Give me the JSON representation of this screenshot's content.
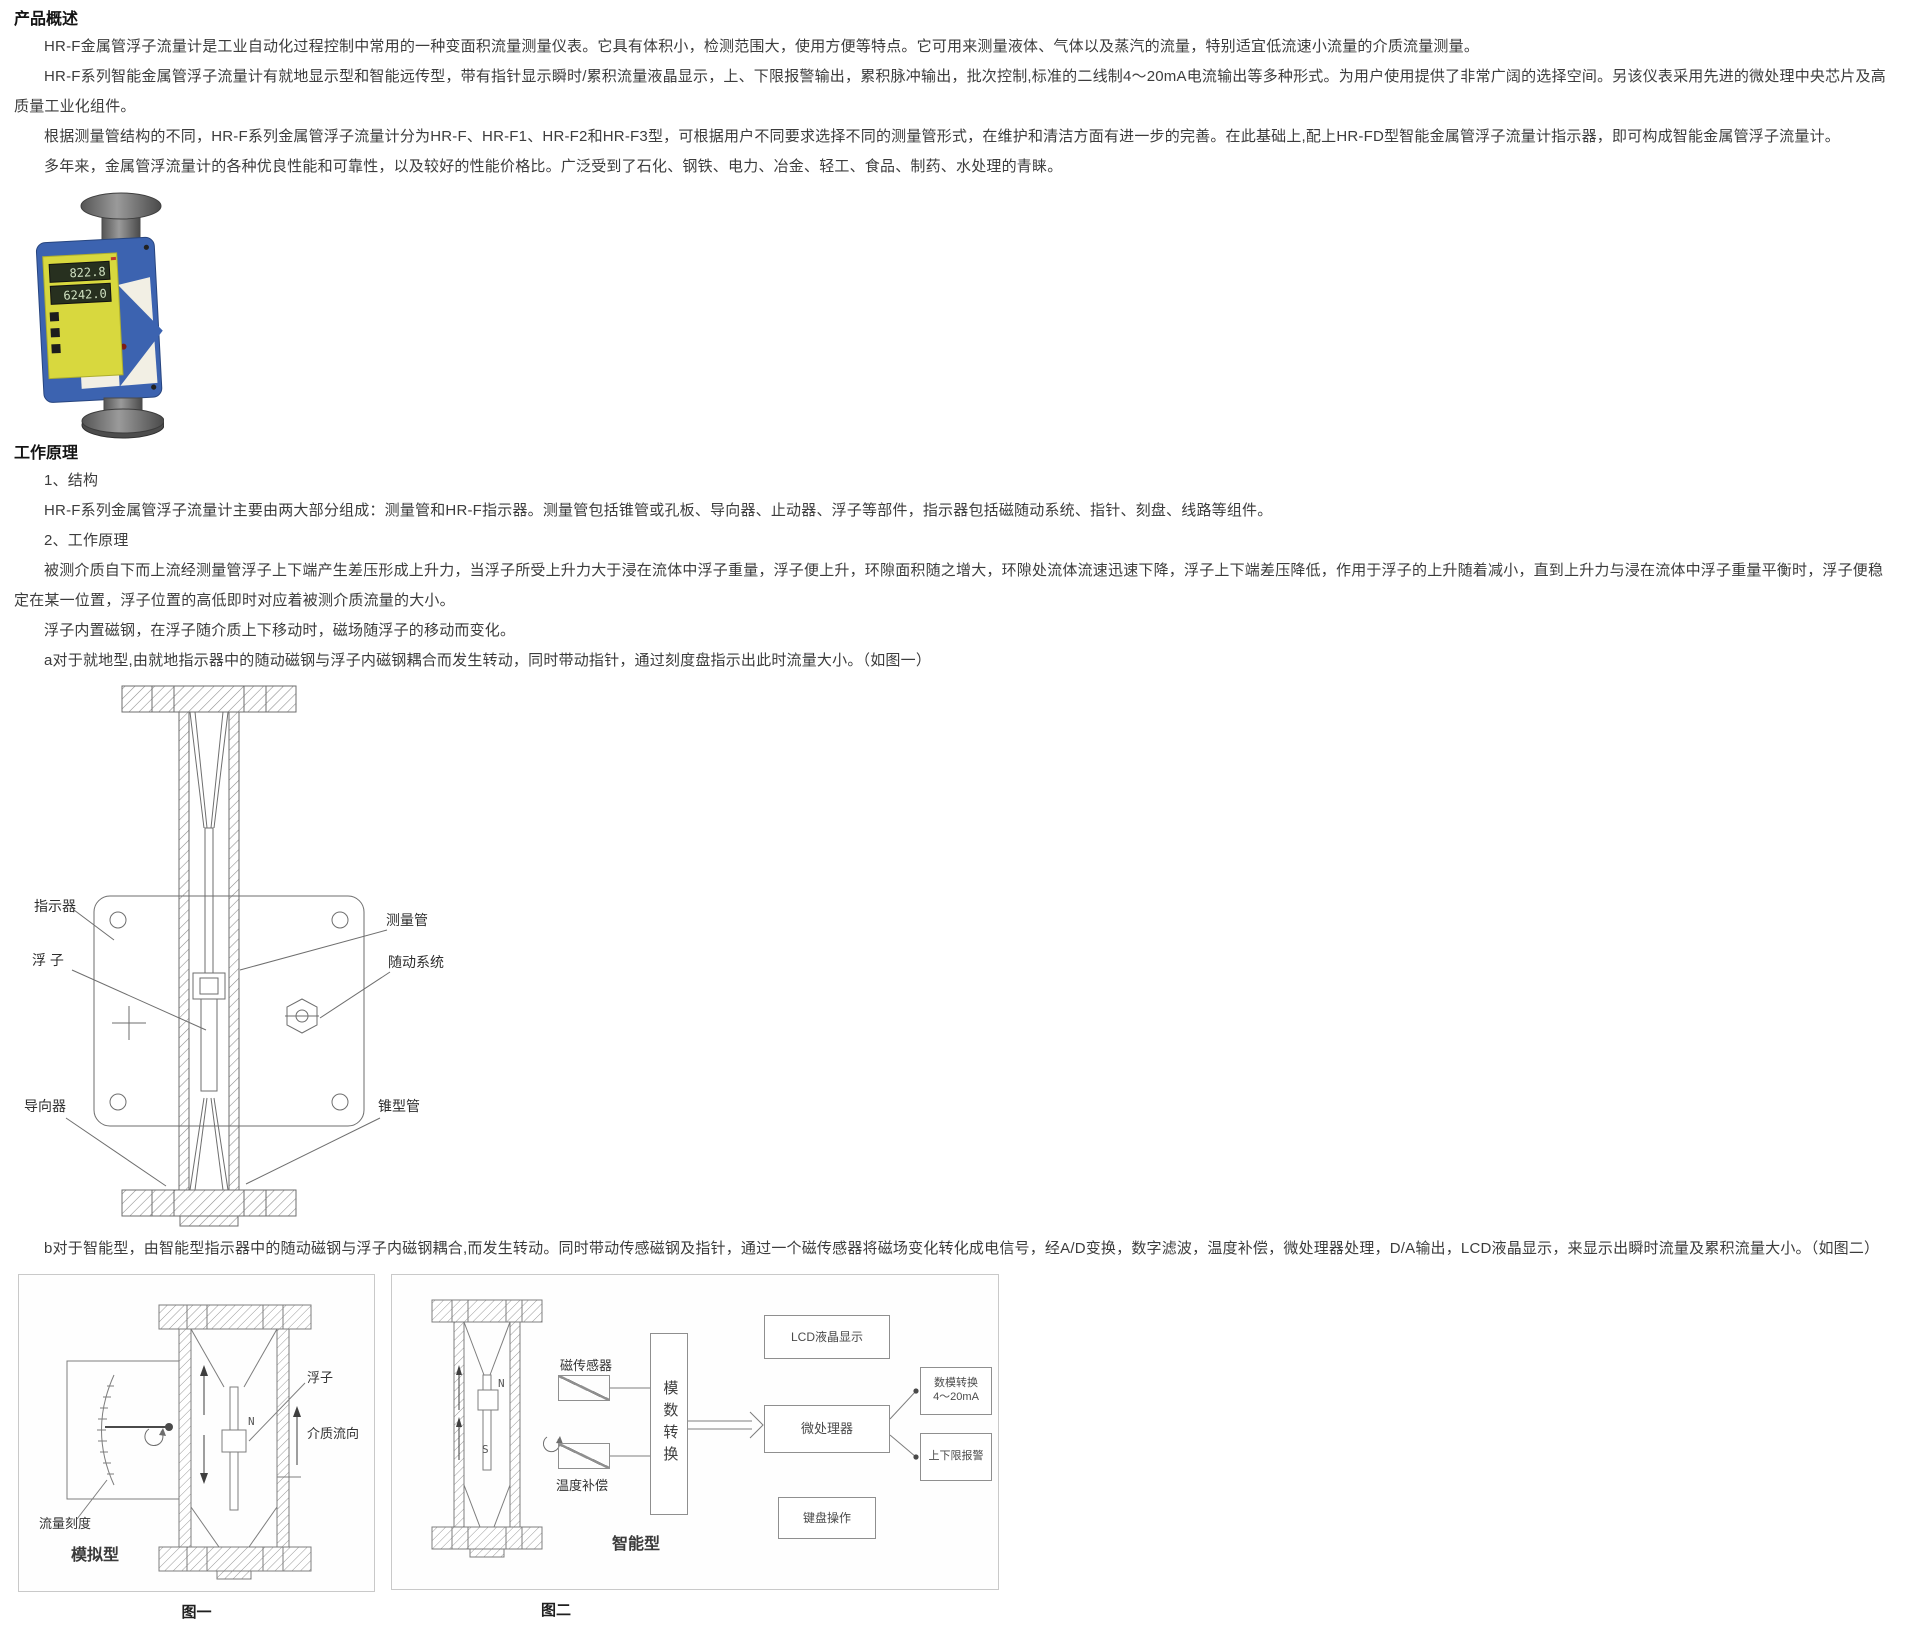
{
  "overview": {
    "heading": "产品概述",
    "paragraphs": [
      "HR-F金属管浮子流量计是工业自动化过程控制中常用的一种变面积流量测量仪表。它具有体积小，检测范围大，使用方便等特点。它可用来测量液体、气体以及蒸汽的流量，特别适宜低流速小流量的介质流量测量。",
      "HR-F系列智能金属管浮子流量计有就地显示型和智能远传型，带有指针显示瞬时/累积流量液晶显示，上、下限报警输出，累积脉冲输出，批次控制,标准的二线制4～20mA电流输出等多种形式。为用户使用提供了非常广阔的选择空间。另该仪表采用先进的微处理中央芯片及高质量工业化组件。",
      "根据测量管结构的不同，HR-F系列金属管浮子流量计分为HR-F、HR-F1、HR-F2和HR-F3型，可根据用户不同要求选择不同的测量管形式，在维护和清洁方面有进一步的完善。在此基础上,配上HR-FD型智能金属管浮子流量计指示器，即可构成智能金属管浮子流量计。",
      "多年来，金属管浮流量计的各种优良性能和可靠性，以及较好的性能价格比。广泛受到了石化、钢铁、电力、冶金、轻工、食品、制药、水处理的青睐。"
    ]
  },
  "photo": {
    "lcd_row1": "822.8",
    "lcd_row2": "6242.0"
  },
  "principle": {
    "heading": "工作原理",
    "item_structure": "1、结构",
    "structure_text": "HR-F系列金属管浮子流量计主要由两大部分组成：测量管和HR-F指示器。测量管包括锥管或孔板、导向器、止动器、浮子等部件，指示器包括磁随动系统、指针、刻盘、线路等组件。",
    "item_principle": "2、工作原理",
    "principle_text": "被测介质自下而上流经测量管浮子上下端产生差压形成上升力，当浮子所受上升力大于浸在流体中浮子重量，浮子便上升，环隙面积随之增大，环隙处流体流速迅速下降，浮子上下端差压降低，作用于浮子的上升随着减小，直到上升力与浸在流体中浮子重量平衡时，浮子便稳定在某一位置，浮子位置的高低即时对应着被测介质流量的大小。",
    "magnet_text": "浮子内置磁钢，在浮子随介质上下移动时，磁场随浮子的移动而变化。",
    "local_text": "a对于就地型,由就地指示器中的随动磁钢与浮子内磁钢耦合而发生转动，同时带动指针，通过刻度盘指示出此时流量大小。（如图一）",
    "smart_text": "b对于智能型，由智能型指示器中的随动磁钢与浮子内磁钢耦合,而发生转动。同时带动传感磁钢及指针，通过一个磁传感器将磁场变化转化成电信号，经A/D变换，数字滤波，温度补偿，微处理器处理，D/A输出，LCD液晶显示，来显示出瞬时流量及累积流量大小。（如图二）"
  },
  "diagram1": {
    "labels": {
      "indicator": "指示器",
      "float": "浮 子",
      "guide": "导向器",
      "measuring_tube": "测量管",
      "follower": "随动系统",
      "cone_tube": "锥型管"
    }
  },
  "figure1": {
    "float_label": "浮子",
    "flow_dir_label": "介质流向",
    "scale_label": "流量刻度",
    "type_label": "模拟型",
    "n_mark": "N",
    "caption": "图一"
  },
  "figure2": {
    "sensor_label": "磁传感器",
    "temp_label": "温度补偿",
    "adc_label": "模数转换",
    "lcd_box": "LCD液晶显示",
    "mpu_box": "微处理器",
    "key_box": "键盘操作",
    "dac_line1": "数模转换",
    "dac_line2": "4～20mA",
    "alarm_box": "上下限报警",
    "type_label": "智能型",
    "n_mark": "N",
    "s_mark": "S",
    "caption": "图二"
  },
  "colors": {
    "body_blue": "#3c63b0",
    "panel_yellow": "#d8d83e",
    "needle_red": "#c43126",
    "flange_gray": "#6f6f6f"
  }
}
